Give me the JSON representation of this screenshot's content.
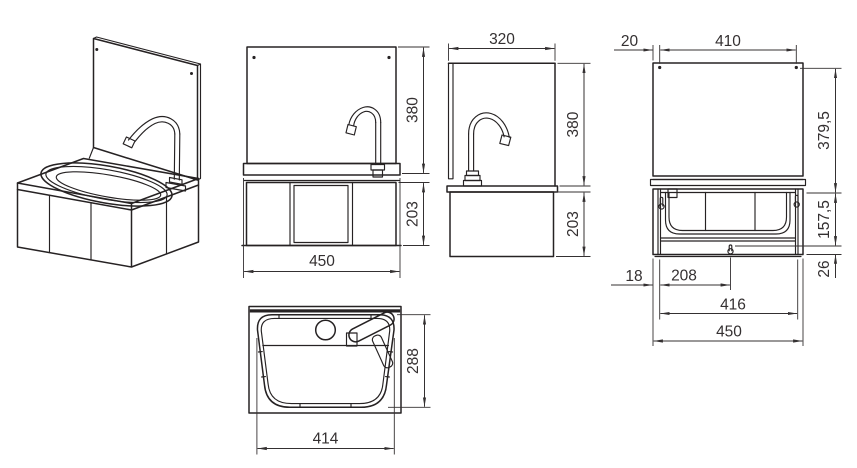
{
  "app": {
    "background": "#ffffff",
    "line_color": "#262223",
    "dim_color": "#343031"
  },
  "views": {
    "front": {
      "dims": {
        "splashback_height": "380",
        "cabinet_height": "203",
        "overall_width": "450"
      }
    },
    "side": {
      "dims": {
        "depth": "320",
        "splashback_height": "380",
        "cabinet_height": "203"
      }
    },
    "rear": {
      "dims": {
        "screw_edge_offset": "20",
        "screw_spacing": "410",
        "panel_height": "379,5",
        "keyhole_height": "157,5",
        "keyhole_bottom": "26",
        "keyhole_edge_offset": "18",
        "keyhole_center_offset": "208",
        "keyhole_spacing": "416",
        "overall_width": "450"
      }
    },
    "top": {
      "dims": {
        "bowl_depth": "288",
        "bowl_width": "414"
      }
    }
  }
}
